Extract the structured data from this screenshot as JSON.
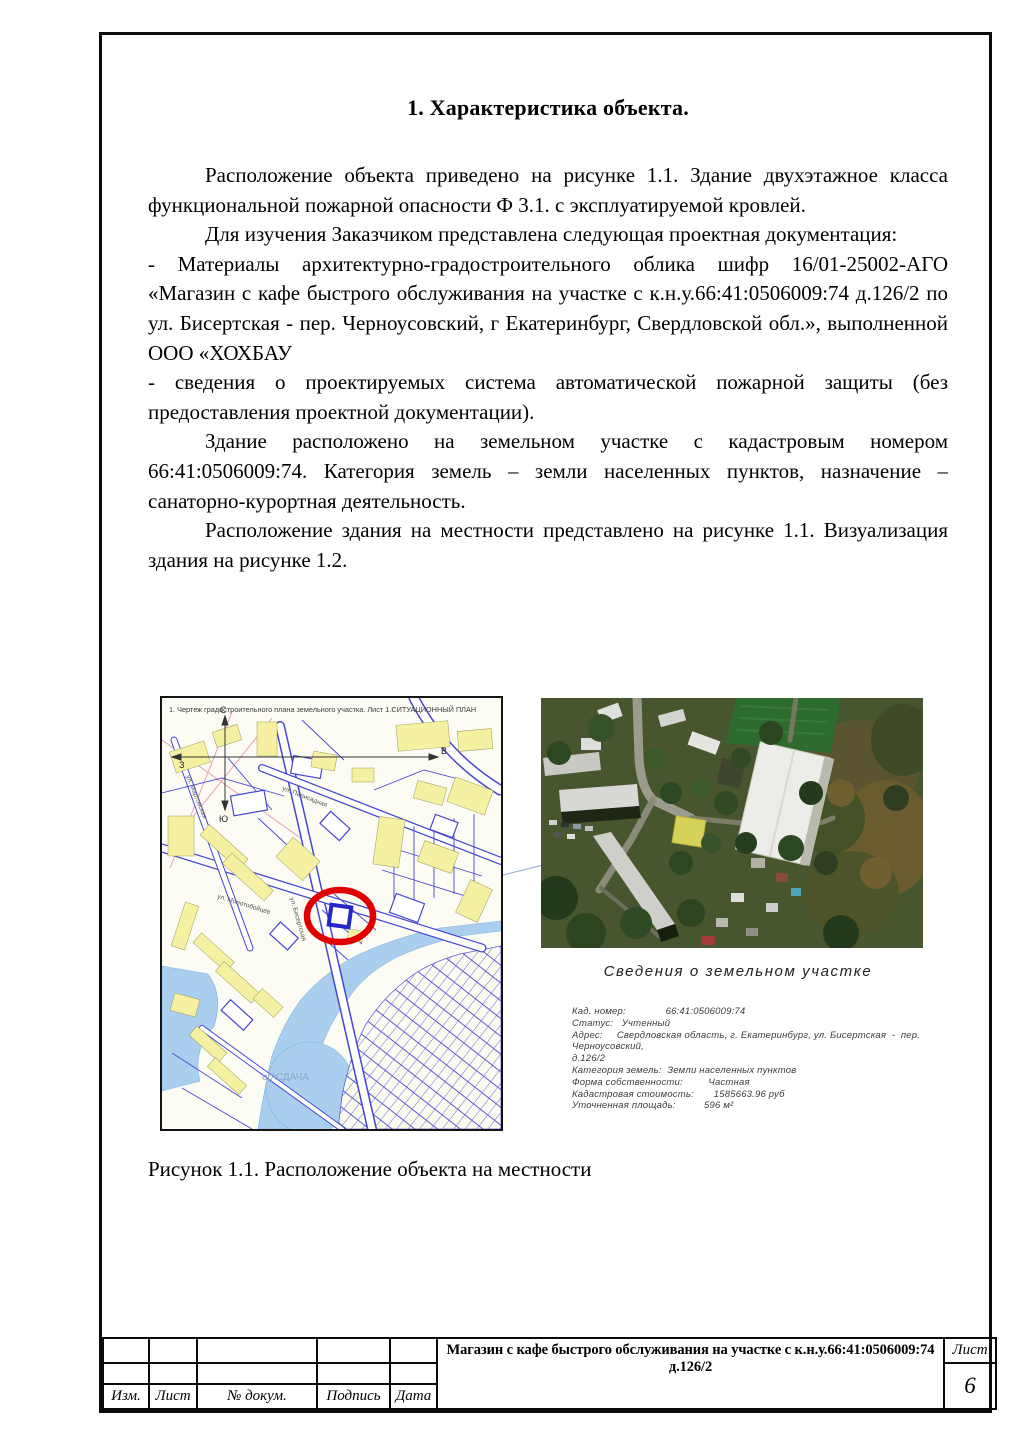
{
  "page": {
    "title": "1. Характеристика объекта.",
    "paragraphs": [
      {
        "indent": true,
        "text": "Расположение объекта приведено на рисунке 1.1. Здание двухэтажное класса функциональной пожарной опасности Ф 3.1. с эксплуатируемой кровлей."
      },
      {
        "indent": true,
        "text": "Для изучения Заказчиком представлена следующая проектная документация:"
      },
      {
        "indent": false,
        "text": "- Материалы архитектурно-градостроительного облика шифр 16/01-25002-АГО «Магазин с кафе быстрого обслуживания на участке с к.н.у.66:41:0506009:74 д.126/2 по ул. Бисертская - пер. Черноусовский, г Екатеринбург, Свердловской обл.», выполненной ООО «ХОХБАУ"
      },
      {
        "indent": false,
        "text": "- сведения о проектируемых система автоматической пожарной защиты (без предоставления проектной документации)."
      },
      {
        "indent": true,
        "text": "Здание расположено на земельном участке с кадастровым номером 66:41:0506009:74. Категория земель – земли населенных пунктов, назначение – санаторно-курортная деятельность."
      },
      {
        "indent": true,
        "text": "Расположение здания на местности представлено на рисунке 1.1. Визуализация здания на рисунке 1.2."
      }
    ],
    "caption": "Рисунок 1.1. Расположение объекта на местности"
  },
  "map": {
    "header": "1. Чертеж градостроительного плана земельного участка. Лист 1.СИТУАЦИОННЫЙ ПЛАН",
    "compass": {
      "north": "С",
      "south": "Ю",
      "east": "В",
      "west": "З"
    },
    "streets": [
      "ул. Бисертская",
      "ул. Молотобойцев",
      "ул. Мартовская",
      "ул. Палисадная"
    ],
    "watermark": "ор\\СДАЧА"
  },
  "parcel_info": {
    "title": "Сведения о земельном участке",
    "lines": [
      "Кад. номер:              66:41:0506009:74",
      "Статус:   Учтенный",
      "Адрес:     Свердловская область, г. Екатеринбург, ул. Бисертская  -  пер. Черноусовский,",
      "д.126/2",
      "Категория земель:  Земли населенных пунктов",
      "Форма собственности:         Частная",
      "Кадастровая стоимость:       1585663.96 руб",
      "Уточненная площадь:          596 м²"
    ]
  },
  "titleblock": {
    "labels": [
      "Изм.",
      "Лист",
      "№ докум.",
      "Подпись",
      "Дата"
    ],
    "document_title": "Магазин с кафе быстрого обслуживания на участке с к.н.у.66:41:0506009:74 д.126/2",
    "sheet_label": "Лист",
    "sheet_number": "6"
  },
  "colors": {
    "map_line_blue": "#4646d0",
    "map_building_yellow": "#f6f1a2",
    "map_water_blue": "#aacfee",
    "marker_red": "#e10000",
    "frame_black": "#0a0a0a"
  }
}
